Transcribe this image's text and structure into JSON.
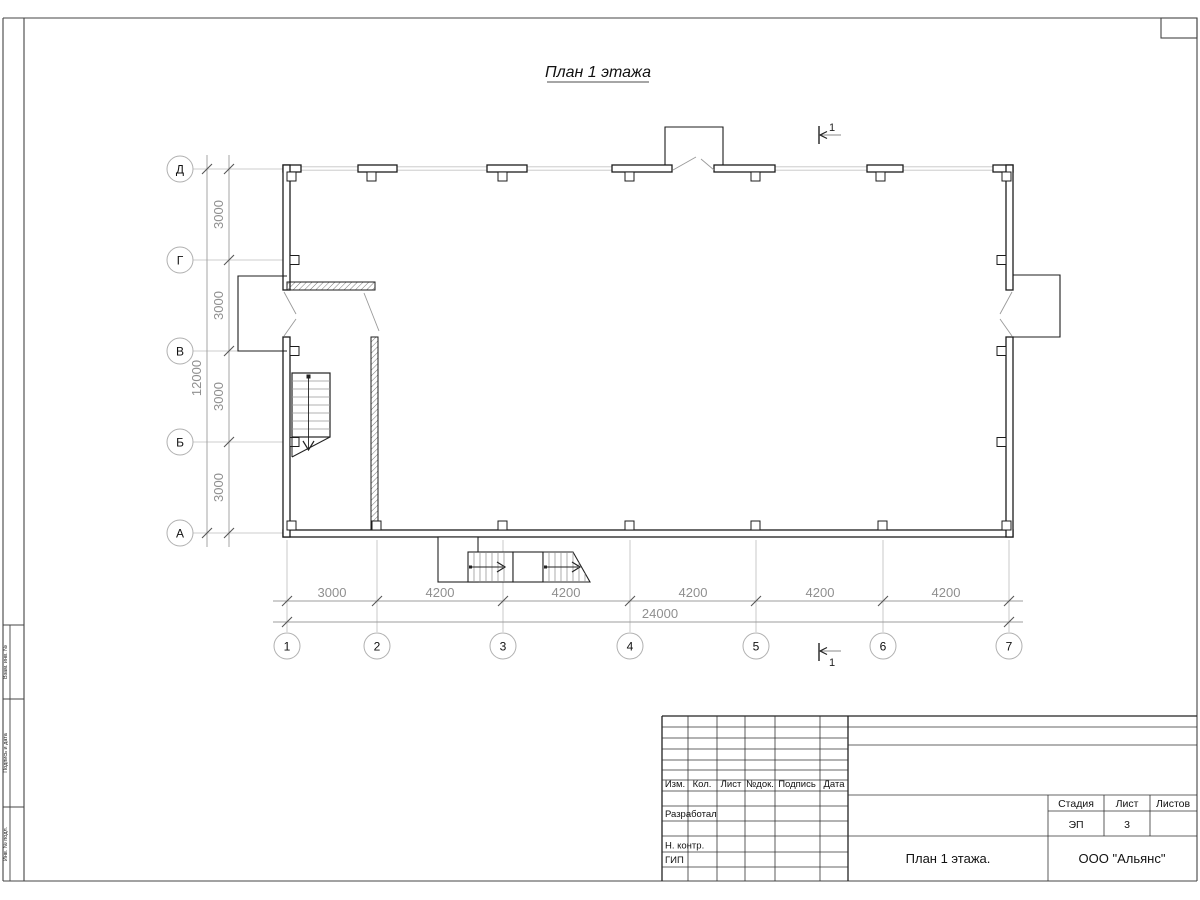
{
  "sheet": {
    "title": "План 1 этажа"
  },
  "colors": {
    "wall": "#1c1c1c",
    "dim_text": "#8f8f8f",
    "grid_line": "#bcbcbc",
    "frame": "#444444"
  },
  "axes": {
    "rows": [
      "Д",
      "Г",
      "В",
      "Б",
      "А"
    ],
    "cols": [
      "1",
      "2",
      "3",
      "4",
      "5",
      "6",
      "7"
    ]
  },
  "dims": {
    "h_segments": [
      "3000",
      "4200",
      "4200",
      "4200",
      "4200",
      "4200"
    ],
    "h_total": "24000",
    "v_segments": [
      "3000",
      "3000",
      "3000",
      "3000"
    ],
    "v_total": "12000"
  },
  "section_marks": {
    "top": "1",
    "bottom": "1"
  },
  "title_block": {
    "columns": [
      "Изм.",
      "Кол.",
      "Лист",
      "№док.",
      "Подпись",
      "Дата"
    ],
    "roles": [
      "Разработал",
      "Н. контр.",
      "ГИП"
    ],
    "stage_label": "Стадия",
    "sheet_label": "Лист",
    "sheets_label": "Листов",
    "stage_value": "ЭП",
    "sheet_value": "3",
    "sheets_value": "",
    "drawing_name": "План 1 этажа.",
    "company": "ООО \"Альянс\""
  },
  "side_stamp": {
    "labels": [
      "Взам. инв. №",
      "Подпись и дата",
      "Инв. № подл."
    ]
  }
}
